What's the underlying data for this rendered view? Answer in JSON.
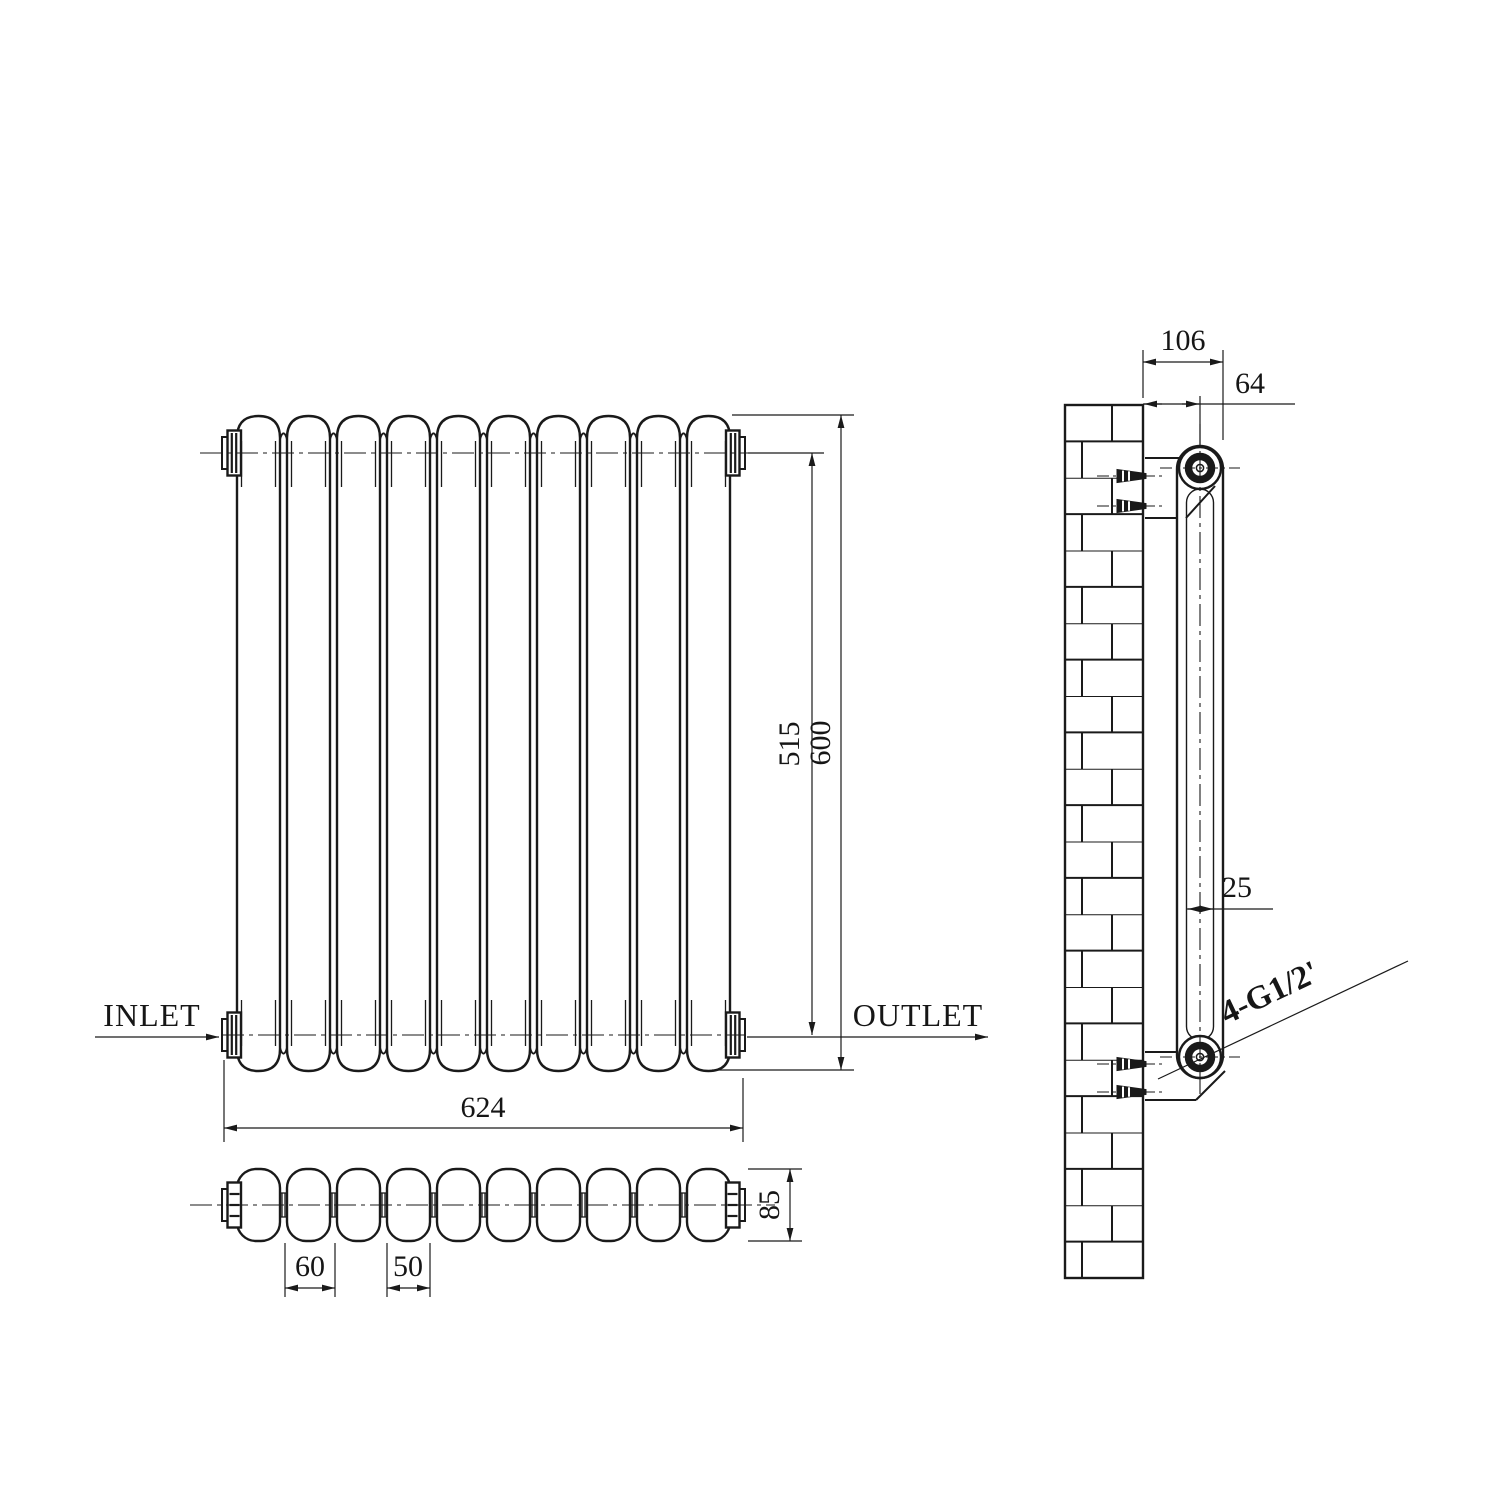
{
  "drawing": {
    "background": "#ffffff",
    "line_color": "#1a1a1a",
    "front_view": {
      "inlet_label": "INLET",
      "outlet_label": "OUTLET",
      "dim_overall_width": "624",
      "dim_overall_height": "600",
      "dim_pipe_centers": "515"
    },
    "top_view": {
      "dim_column_pitch": "60",
      "dim_column_width": "50",
      "dim_depth": "85"
    },
    "side_view": {
      "dim_bracket_depth": "106",
      "dim_pipe_center_offset": "64",
      "dim_column_tube": "25",
      "connection_label": "4-G1/2'"
    }
  }
}
